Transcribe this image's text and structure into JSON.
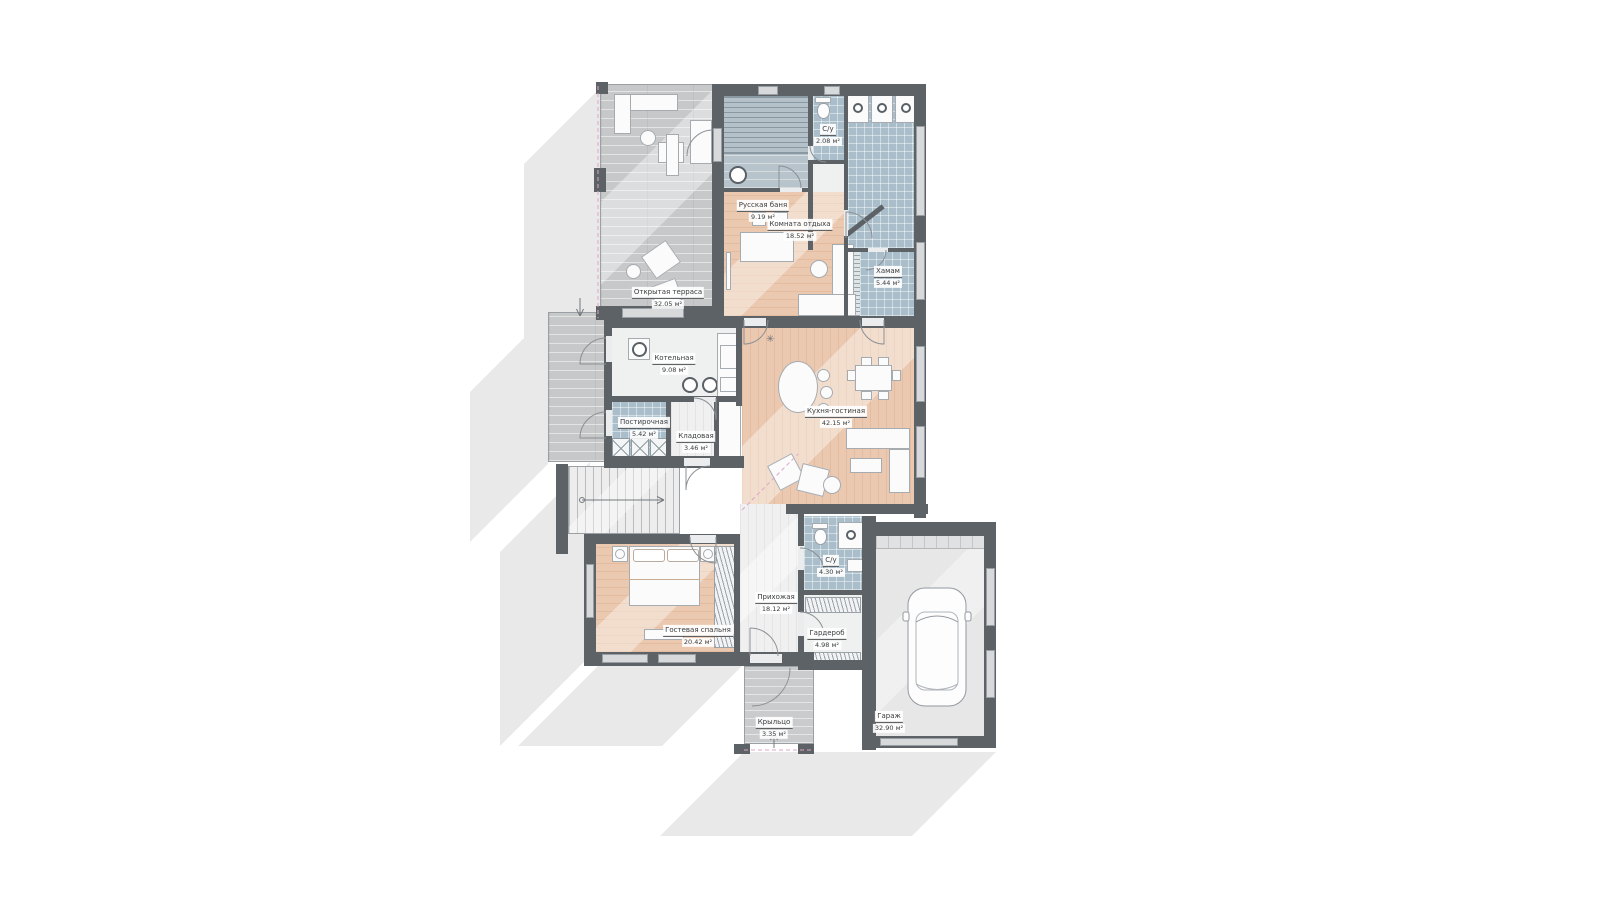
{
  "plan": {
    "title": "План первого этажа",
    "colors": {
      "wall": "#5d6266",
      "floor_peach": "#ebc9b0",
      "floor_tile": "#a9bdca",
      "floor_wood_gray": "#c6c8c9",
      "floor_light": "#eff0f0",
      "floor_garage": "#e7e7e8",
      "shadow": "#e9e9e9",
      "dashed_accent": "#dba6c6"
    },
    "rooms": [
      {
        "name": "Открытая терраса",
        "area": "32.05 м²"
      },
      {
        "name": "Русская баня",
        "area": "9.19 м²"
      },
      {
        "name": "С/у",
        "area": "2.08 м²"
      },
      {
        "name": "Комната отдыха",
        "area": "18.52 м²"
      },
      {
        "name": "Хамам",
        "area": "5.44 м²"
      },
      {
        "name": "Котельная",
        "area": "9.08 м²"
      },
      {
        "name": "Постирочная",
        "area": "5.42 м²"
      },
      {
        "name": "Кладовая",
        "area": "3.46 м²"
      },
      {
        "name": "Кухня-гостиная",
        "area": "42.15 м²"
      },
      {
        "name": "Гостевая спальня",
        "area": "20.42 м²"
      },
      {
        "name": "Прихожая",
        "area": "18.12 м²"
      },
      {
        "name": "С/у",
        "area": "4.30 м²"
      },
      {
        "name": "Гардероб",
        "area": "4.98 м²"
      },
      {
        "name": "Крыльцо",
        "area": "3.35 м²"
      },
      {
        "name": "Гараж",
        "area": "32.90 м²"
      }
    ]
  }
}
